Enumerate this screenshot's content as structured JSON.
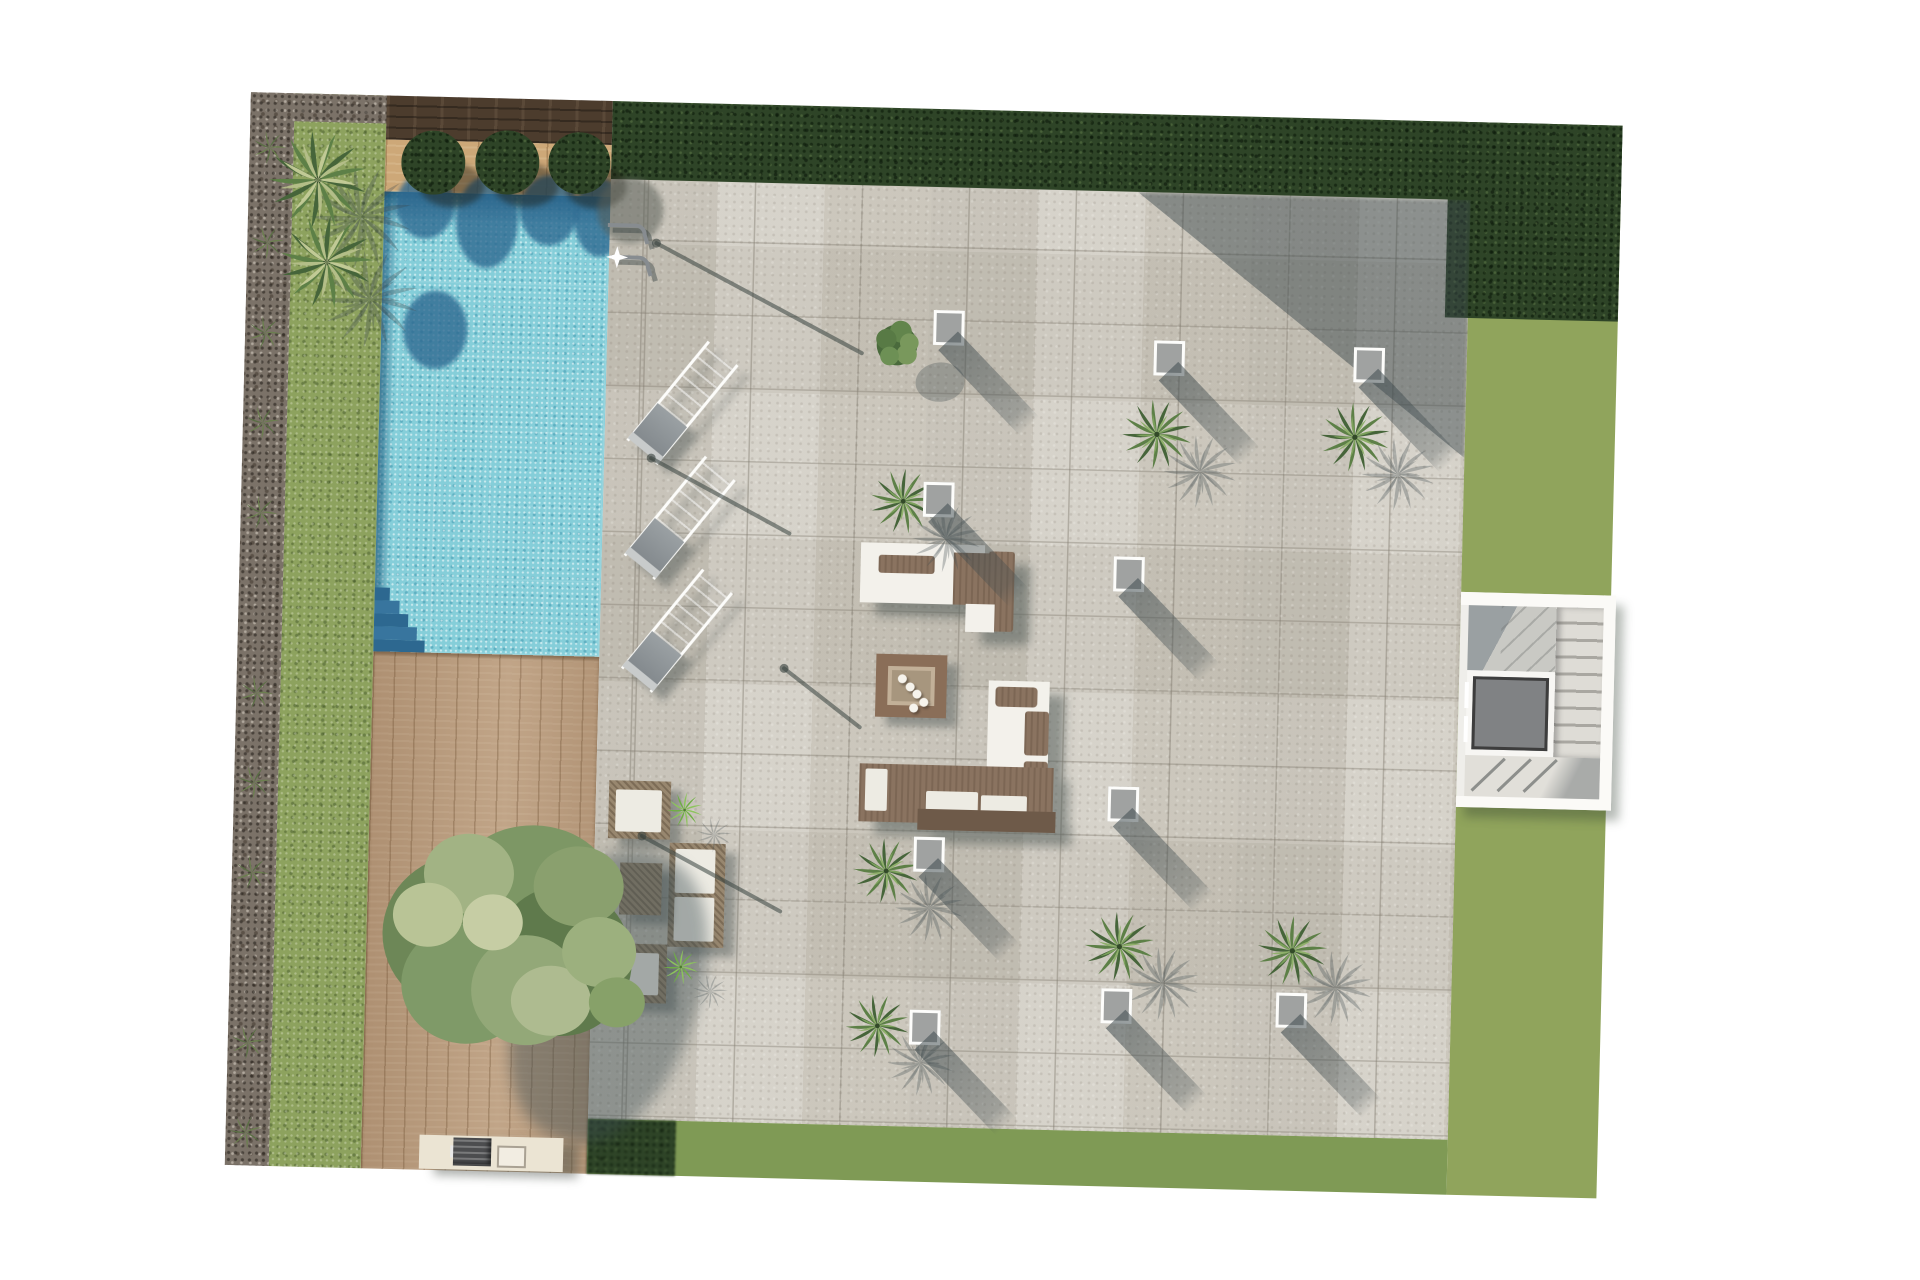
{
  "meta": {
    "title": "Terrace landscape plan – top view render",
    "view": "top-down",
    "visible_text": "none"
  },
  "colors": {
    "page": "#ffffff",
    "gravel": "#7b7268",
    "grass": "#8da25e",
    "grass_right": "#90a45c",
    "grass_bottom": "#7f9a55",
    "hedge": "#2e4427",
    "wood_dark": "#4c3c2d",
    "wood_light": "#cda878",
    "deck": "#ba9d80",
    "pool": "#85ced9",
    "pool_dark": "#2d6890",
    "terrace": "#cdc9bf",
    "furn_white": "#f3f1eb",
    "furn_brown": "#8a7360",
    "rattan": "#98876f",
    "cushion": "#edebe3",
    "light_gray": "#a0a2a1",
    "elev": "#808284",
    "elev_dark": "#3d3d3d",
    "bbq": "#ebe4d3",
    "grill": "#4c4d4f",
    "fire_frame": "#8a6e58",
    "fire_in": "#c2b098",
    "fire_pit": "#a7967e",
    "shadow": "rgba(62,74,78,0.5)",
    "palm_dark": "#46653a",
    "palm_mid": "#5d8047",
    "palm_light_a": "#7ca15c",
    "palm_light_b": "#8fb06b",
    "palm_pale_a": "#c9cf9c",
    "palm_pale_b": "#b8c08c",
    "agave_a": "#6fae45",
    "agave_b": "#8cc45c",
    "tuft_a": "#5a6f44",
    "tuft_b": "#6b7f4f"
  },
  "labels": {
    "pool": "swimming pool",
    "pool_ladder": "pool ladder",
    "deck": "wooden deck",
    "terrace": "stone tile terrace",
    "lawn_left": "lawn strip",
    "lawn_right": "lawn",
    "lawn_bottom": "lawn strip",
    "gravel": "gravel border",
    "hedge_top": "hedge",
    "hedge_right": "hedge",
    "planter": "wood planter",
    "bushes": "round bushes",
    "palms": "palm trees",
    "lights": "square ground lights",
    "loungers": "sun loungers",
    "daybed": "daybed lounge group",
    "fire_table": "fire table",
    "l_sofa": "L-shaped lounge sofa",
    "lounge_set": "garden lounge set",
    "tree": "large tree",
    "bbq": "barbecue counter",
    "stairs": "staircase",
    "elevator": "elevator",
    "sparkle": "water sparkle"
  },
  "counts": {
    "sun_loungers": 3,
    "terrace_palms": 8,
    "ground_lights": 10,
    "planter_bushes": 3,
    "fire_pebbles": 5,
    "entry_palms": 2
  },
  "plan": {
    "palms": [
      {
        "x": 77,
        "y": 86,
        "s": 1.05,
        "v": "pale"
      },
      {
        "x": 88,
        "y": 168,
        "s": 1.0,
        "v": "pale"
      },
      {
        "x": 660,
        "y": 237,
        "s": 0.78,
        "v": "shrub"
      },
      {
        "x": 922,
        "y": 320,
        "s": 0.75,
        "v": "palm"
      },
      {
        "x": 1120,
        "y": 318,
        "s": 0.75,
        "v": "palm"
      },
      {
        "x": 670,
        "y": 393,
        "s": 0.7,
        "v": "palm"
      },
      {
        "x": 662,
        "y": 763,
        "s": 0.7,
        "v": "palm"
      },
      {
        "x": 897,
        "y": 833,
        "s": 0.75,
        "v": "palm"
      },
      {
        "x": 1070,
        "y": 833,
        "s": 0.75,
        "v": "palm"
      },
      {
        "x": 657,
        "y": 918,
        "s": 0.68,
        "v": "palm"
      }
    ],
    "plants": [
      {
        "x": 459,
        "y": 707,
        "s": 0.52
      },
      {
        "x": 459,
        "y": 864,
        "s": 0.52
      }
    ],
    "lights": [
      {
        "x": 696,
        "y": 201
      },
      {
        "x": 917,
        "y": 226
      },
      {
        "x": 1117,
        "y": 228
      },
      {
        "x": 690,
        "y": 373
      },
      {
        "x": 882,
        "y": 443
      },
      {
        "x": 882,
        "y": 673
      },
      {
        "x": 689,
        "y": 728
      },
      {
        "x": 689,
        "y": 901
      },
      {
        "x": 880,
        "y": 875
      },
      {
        "x": 1055,
        "y": 875
      }
    ],
    "shadow_lines": [
      {
        "x1": 417,
        "y1": 141,
        "x2": 625,
        "y2": 246
      },
      {
        "x1": 417,
        "y1": 356,
        "x2": 557,
        "y2": 428
      },
      {
        "x1": 555,
        "y1": 563,
        "x2": 632,
        "y2": 620
      },
      {
        "x1": 417,
        "y1": 734,
        "x2": 557,
        "y2": 806
      }
    ],
    "tufts": [
      {
        "y": 55
      },
      {
        "y": 150
      },
      {
        "y": 240
      },
      {
        "y": 330
      },
      {
        "y": 420
      },
      {
        "y": 600
      },
      {
        "y": 690
      },
      {
        "y": 780
      },
      {
        "y": 950
      },
      {
        "y": 1040
      }
    ],
    "pebbles": [
      {
        "x": 16,
        "y": 14
      },
      {
        "x": 24,
        "y": 22
      },
      {
        "x": 31,
        "y": 29
      },
      {
        "x": 38,
        "y": 37
      },
      {
        "x": 28,
        "y": 43
      }
    ]
  }
}
